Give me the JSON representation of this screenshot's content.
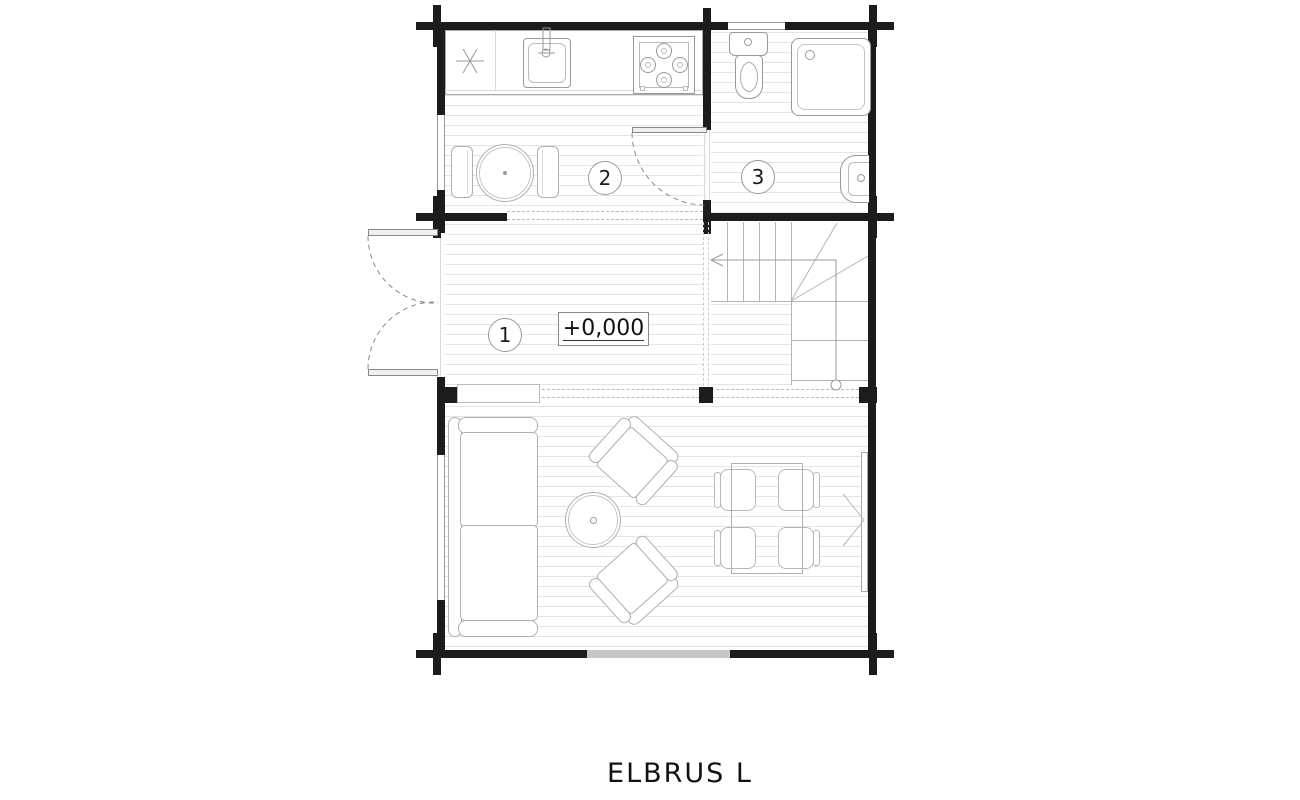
{
  "title": "ELBRUS  L",
  "level_marker": "+0,000",
  "rooms": {
    "hall": {
      "number": "1"
    },
    "kitchen": {
      "number": "2"
    },
    "bathroom": {
      "number": "3"
    }
  },
  "fixtures": {
    "kitchen": [
      "fridge-asterisk-icon",
      "kitchen-sink-icon",
      "stove-icon",
      "kitchen-table",
      "kitchen-chairs"
    ],
    "bathroom": [
      "toilet-icon",
      "shower-icon",
      "washbasin-icon"
    ],
    "hall": [
      "entrance-double-door",
      "stairs",
      "bathroom-door"
    ],
    "living": [
      "sofa",
      "coffee-table",
      "armchair",
      "armchair",
      "dining-table",
      "dining-chairs",
      "window-leaf"
    ]
  },
  "colors": {
    "wall": "#1c1c1c",
    "fixture_line": "#999999",
    "furniture_line": "#b0b0b0",
    "hatch_line": "#e4e4e4",
    "window_fill": "#c6c6c6",
    "background": "#ffffff"
  }
}
